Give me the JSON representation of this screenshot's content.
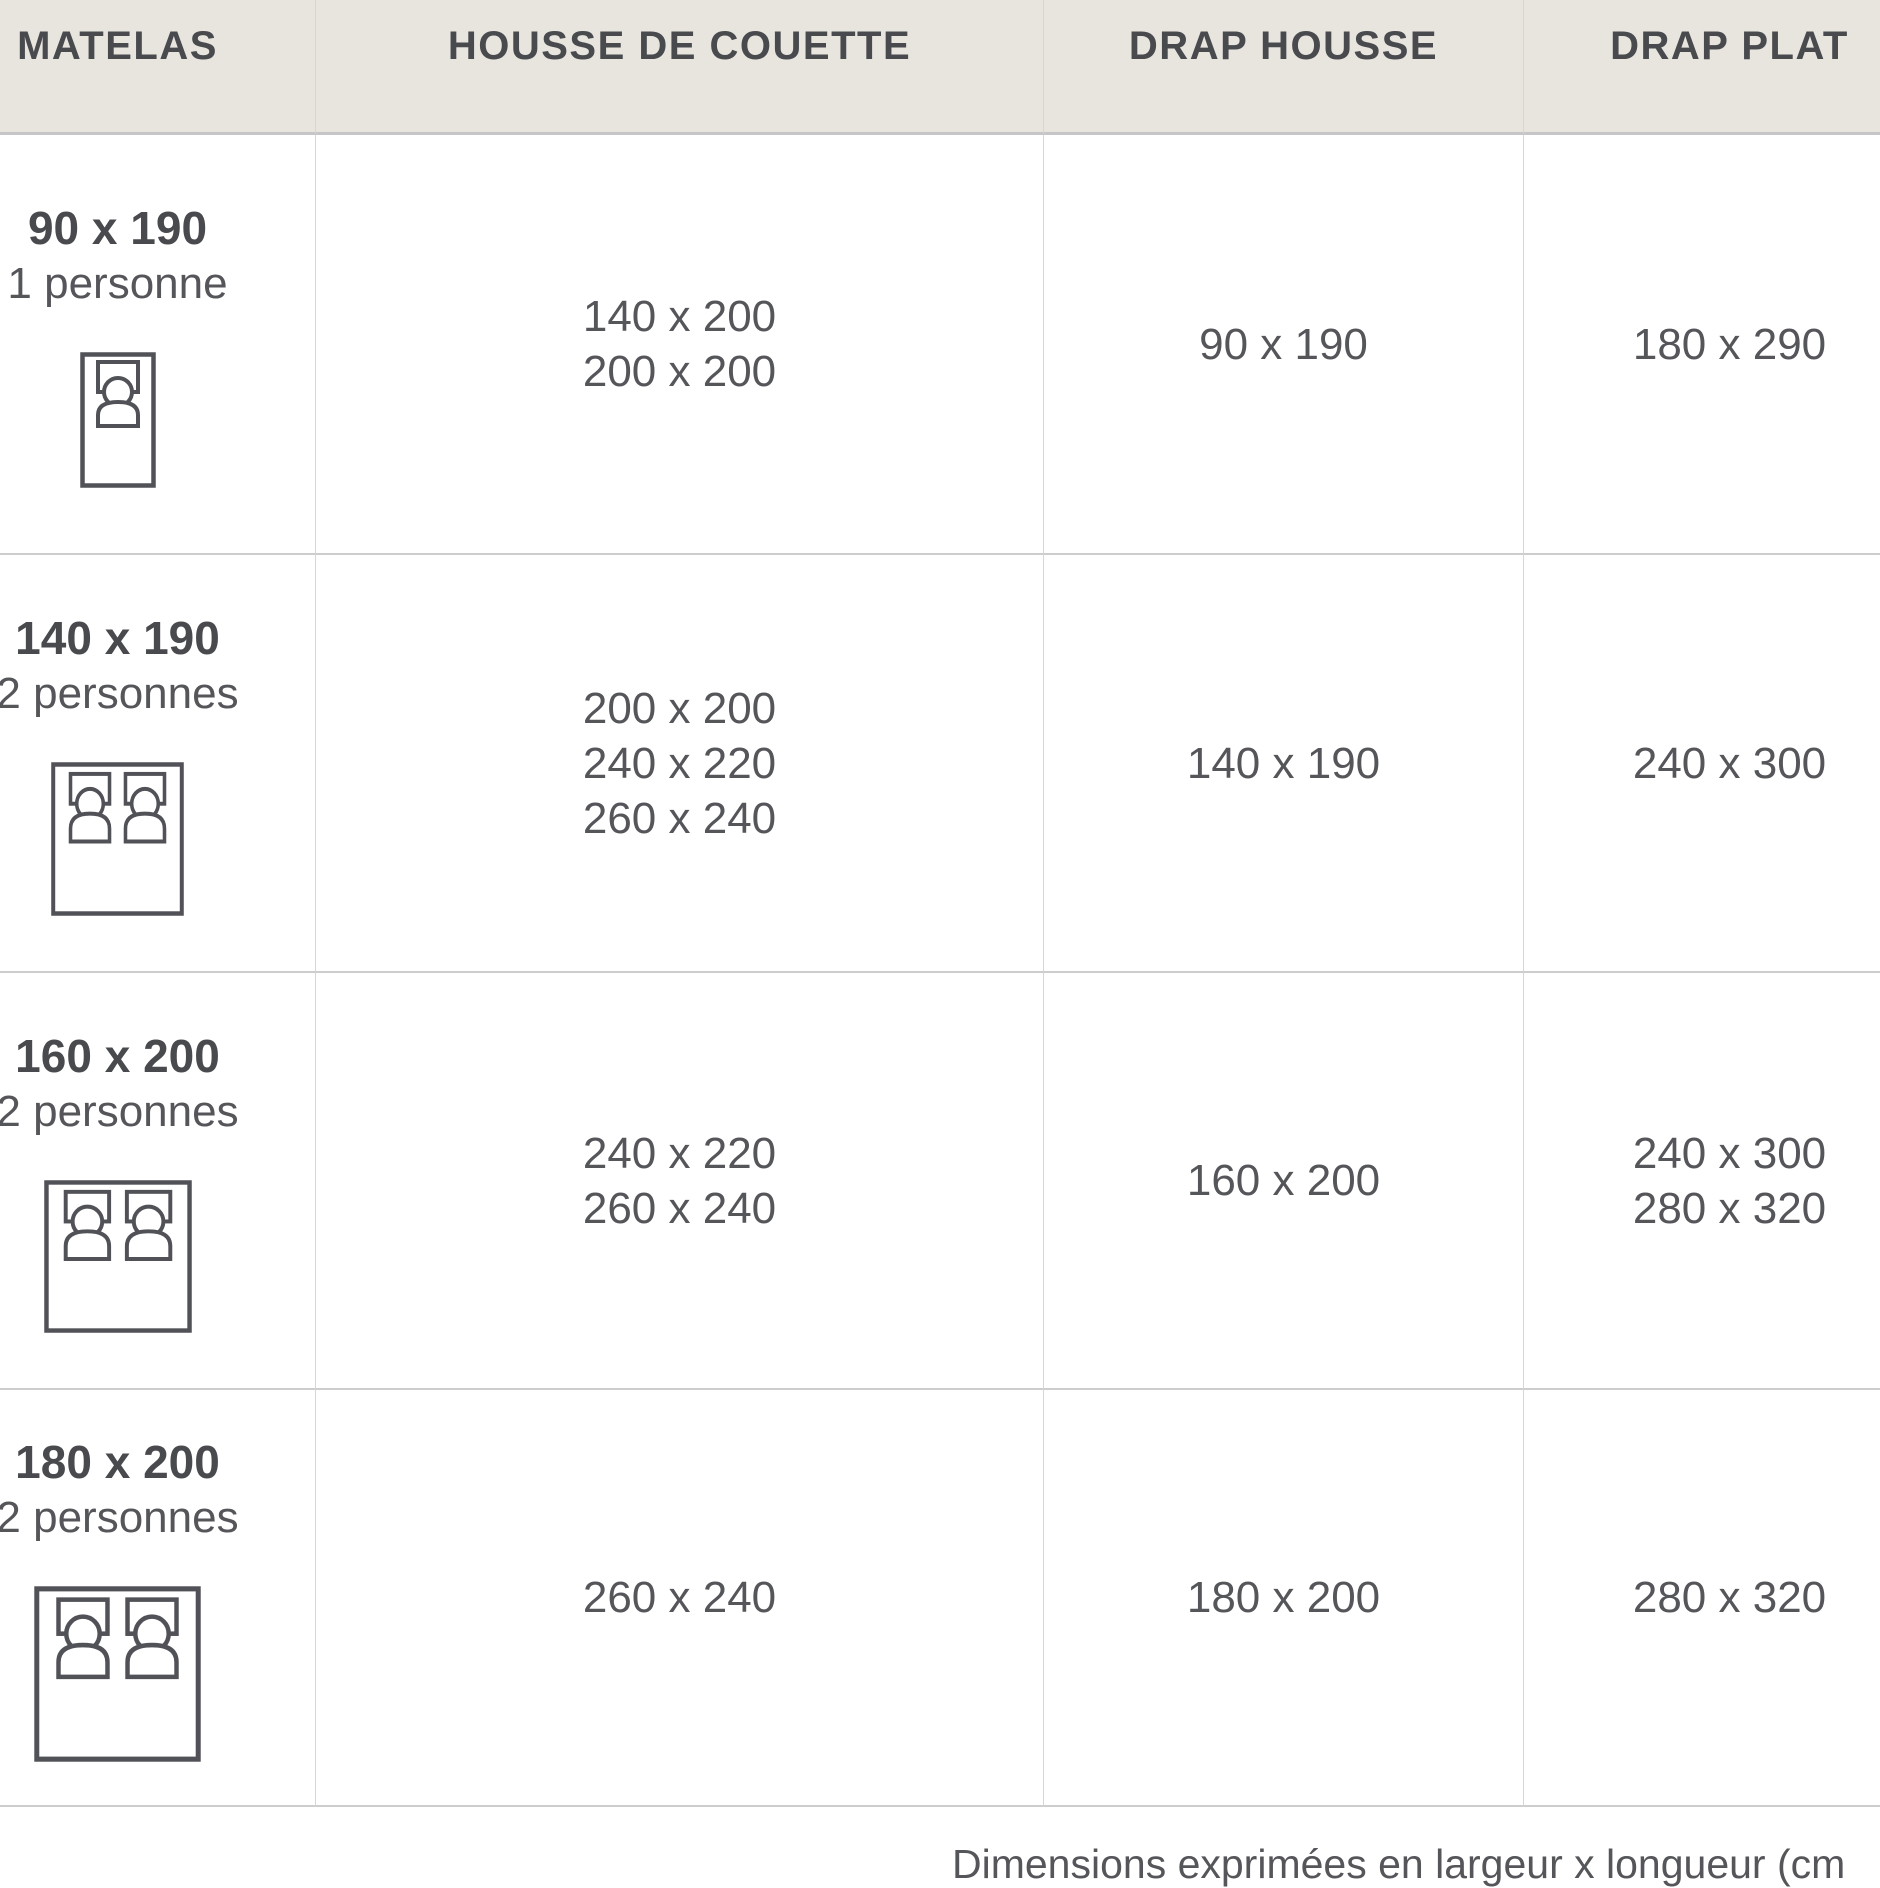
{
  "chart_data": {
    "type": "table",
    "columns": [
      "MATELAS",
      "HOUSSE DE COUETTE",
      "DRAP HOUSSE",
      "DRAP PLAT"
    ],
    "rows": [
      {
        "matelas_size": "90 x 190",
        "capacity": "1 personne",
        "bed_icon": "single-bed-icon",
        "housse_de_couette": [
          "140 x 200",
          "200 x 200"
        ],
        "drap_housse": [
          "90 x 190"
        ],
        "drap_plat": [
          "180 x 290"
        ]
      },
      {
        "matelas_size": "140 x 190",
        "capacity": "2 personnes",
        "bed_icon": "double-bed-icon",
        "housse_de_couette": [
          "200 x 200",
          "240 x 220",
          "260 x 240"
        ],
        "drap_housse": [
          "140 x 190"
        ],
        "drap_plat": [
          "240 x 300"
        ]
      },
      {
        "matelas_size": "160 x 200",
        "capacity": "2 personnes",
        "bed_icon": "double-bed-icon",
        "housse_de_couette": [
          "240 x 220",
          "260 x 240"
        ],
        "drap_housse": [
          "160 x 200"
        ],
        "drap_plat": [
          "240 x 300",
          "280 x 320"
        ]
      },
      {
        "matelas_size": "180 x 200",
        "capacity": "2 personnes",
        "bed_icon": "double-bed-icon",
        "housse_de_couette": [
          "260 x 240"
        ],
        "drap_housse": [
          "180 x 200"
        ],
        "drap_plat": [
          "280 x 320"
        ]
      }
    ],
    "footnote": "Dimensions exprimées en largeur x longueur (cm",
    "layout_hints": {
      "legend": "none",
      "grid": "on",
      "header_background": "#e8e5df"
    }
  },
  "colors": {
    "header_bg": "#e8e5df",
    "row_bg": "#ffffff",
    "border_horizontal": "#c9c9c9",
    "border_vertical": "#d6d6d6",
    "text_dark": "#494a4e",
    "text": "#55565a",
    "icon_stroke": "#515257"
  }
}
